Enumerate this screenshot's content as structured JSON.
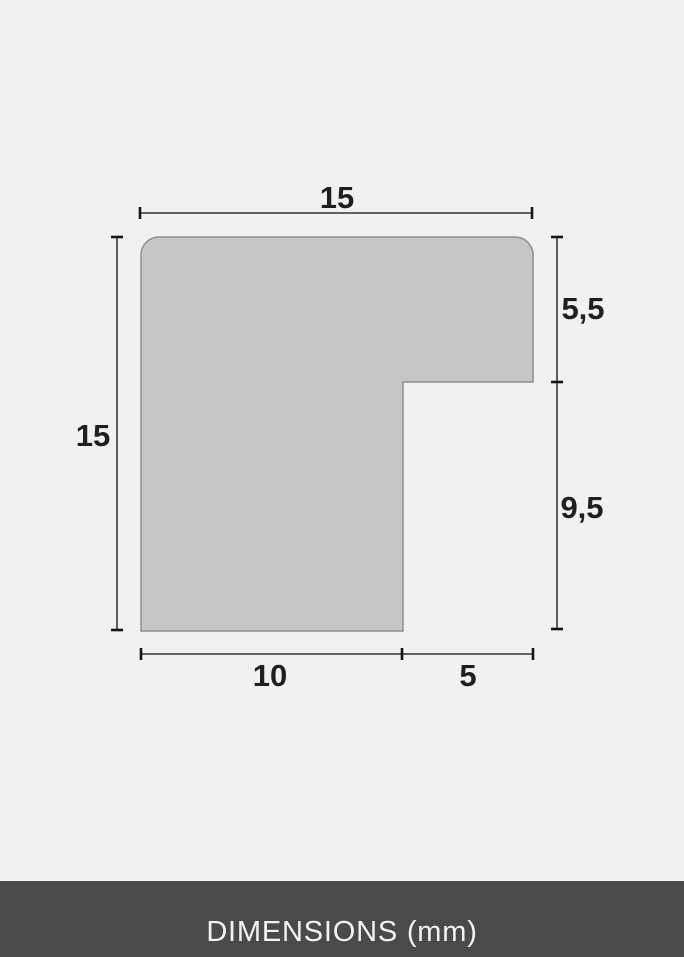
{
  "profile": {
    "dimensions": {
      "top_width": "15",
      "left_height": "15",
      "right_upper": "5,5",
      "right_lower": "9,5",
      "bottom_inner": "10",
      "bottom_outer": "5"
    }
  },
  "footer": {
    "caption": "DIMENSIONS (mm)"
  },
  "colors": {
    "background": "#f1f1f0",
    "shape_fill": "#c7c6c5",
    "shape_stroke": "#8e8d8c",
    "dimension_line": "#4d4d4d",
    "tick": "#141414",
    "label_text": "#1f1f1f",
    "footer_background": "#4b494a",
    "footer_text": "#f2f2f1"
  }
}
